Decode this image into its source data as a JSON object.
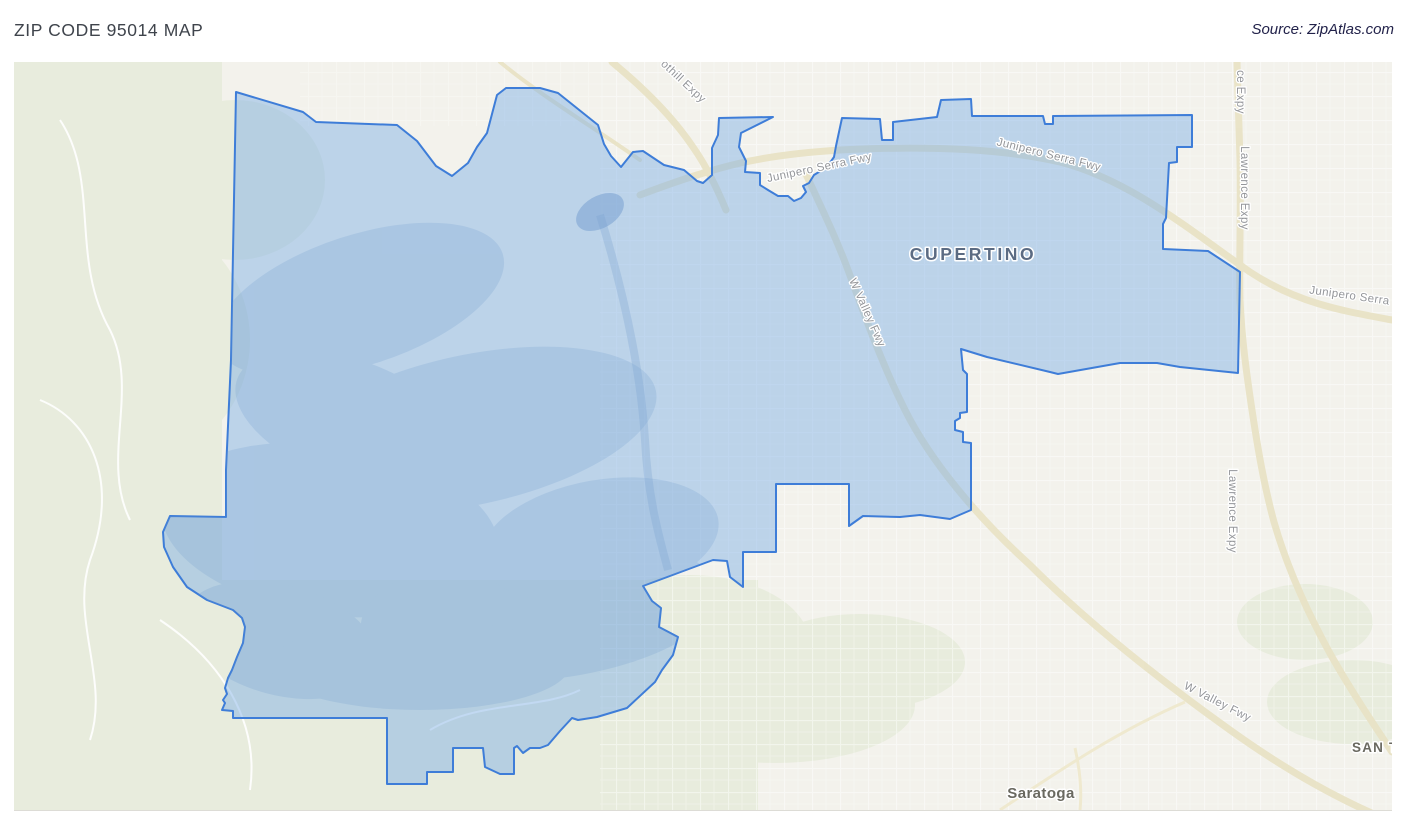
{
  "header": {
    "title": "ZIP CODE 95014 MAP",
    "source": "Source: ZipAtlas.com"
  },
  "map": {
    "colors": {
      "map_bg": "#f3f2ec",
      "greenery": "#e8ecdd",
      "freeway": "#e9e3c6",
      "minor_road": "#efe9cf",
      "boundary_stroke": "#3e7dd8",
      "boundary_fill": "rgba(122,172,230,0.45)",
      "hill_shade": "#6f9cce",
      "road_label": "#94969a",
      "city_label": "#5b6b83",
      "town_label": "#6a6960"
    },
    "city_labels": [
      {
        "name": "city-label-cupertino",
        "text": "CUPERTINO",
        "x": 973,
        "y": 260,
        "rotate": 0,
        "cls": "lbl-city",
        "anchor": "middle"
      },
      {
        "name": "town-label-saratoga",
        "text": "Saratoga",
        "x": 1041,
        "y": 798,
        "rotate": 0,
        "cls": "lbl-town",
        "anchor": "middle"
      },
      {
        "name": "town-label-san-tomas",
        "text": "SAN TO",
        "x": 1352,
        "y": 752,
        "rotate": 0,
        "cls": "lbl-town-caps",
        "anchor": "start"
      }
    ],
    "road_labels": [
      {
        "name": "road-label-junipero-serra-fwy-west",
        "text": "Junipero Serra Fwy",
        "x": 820,
        "y": 171,
        "rotate": -12,
        "cls": "lbl-road",
        "anchor": "middle"
      },
      {
        "name": "road-label-junipero-serra-fwy-east",
        "text": "Junipero Serra Fwy",
        "x": 1048,
        "y": 158,
        "rotate": 14,
        "cls": "lbl-road",
        "anchor": "middle"
      },
      {
        "name": "road-label-junipero-serra-right-edge",
        "text": "Junipero Serra",
        "x": 1349,
        "y": 299,
        "rotate": 8,
        "cls": "lbl-road",
        "anchor": "middle"
      },
      {
        "name": "road-label-lawrence-expy-top-cut",
        "text": "ce Expy",
        "x": 1237,
        "y": 92,
        "rotate": 90,
        "cls": "lbl-road",
        "anchor": "middle"
      },
      {
        "name": "road-label-lawrence-expy-upper",
        "text": "Lawrence Expy",
        "x": 1241,
        "y": 188,
        "rotate": 90,
        "cls": "lbl-road",
        "anchor": "middle"
      },
      {
        "name": "road-label-lawrence-expy-lower",
        "text": "Lawrence Expy",
        "x": 1229,
        "y": 511,
        "rotate": 90,
        "cls": "lbl-road",
        "anchor": "middle"
      },
      {
        "name": "road-label-w-valley-fwy-mid",
        "text": "W Valley Fwy",
        "x": 864,
        "y": 314,
        "rotate": 66,
        "cls": "lbl-road",
        "anchor": "middle"
      },
      {
        "name": "road-label-w-valley-fwy-bottom",
        "text": "W Valley Fwy",
        "x": 1216,
        "y": 705,
        "rotate": 27,
        "cls": "lbl-road",
        "anchor": "middle"
      },
      {
        "name": "road-label-foothill-expy-cut",
        "text": "othill Expy",
        "x": 681,
        "y": 84,
        "rotate": 43,
        "cls": "lbl-road",
        "anchor": "middle"
      }
    ],
    "zip_boundary": [
      [
        236,
        92
      ],
      [
        303,
        112
      ],
      [
        316,
        122
      ],
      [
        397,
        125
      ],
      [
        417,
        141
      ],
      [
        436,
        166
      ],
      [
        452,
        176
      ],
      [
        468,
        163
      ],
      [
        477,
        147
      ],
      [
        487,
        133
      ],
      [
        497,
        95
      ],
      [
        506,
        88
      ],
      [
        540,
        88
      ],
      [
        558,
        93
      ],
      [
        598,
        125
      ],
      [
        604,
        144
      ],
      [
        611,
        156
      ],
      [
        621,
        167
      ],
      [
        633,
        152
      ],
      [
        643,
        151
      ],
      [
        664,
        165
      ],
      [
        684,
        170
      ],
      [
        697,
        181
      ],
      [
        703,
        183
      ],
      [
        712,
        175
      ],
      [
        712,
        148
      ],
      [
        718,
        135
      ],
      [
        719,
        118
      ],
      [
        773,
        117
      ],
      [
        741,
        133
      ],
      [
        739,
        147
      ],
      [
        746,
        161
      ],
      [
        745,
        172
      ],
      [
        760,
        173
      ],
      [
        760,
        185
      ],
      [
        768,
        190
      ],
      [
        778,
        196
      ],
      [
        788,
        196
      ],
      [
        794,
        201
      ],
      [
        801,
        198
      ],
      [
        806,
        192
      ],
      [
        803,
        186
      ],
      [
        809,
        183
      ],
      [
        814,
        175
      ],
      [
        827,
        167
      ],
      [
        834,
        157
      ],
      [
        836,
        146
      ],
      [
        842,
        118
      ],
      [
        880,
        119
      ],
      [
        882,
        140
      ],
      [
        893,
        140
      ],
      [
        893,
        122
      ],
      [
        937,
        117
      ],
      [
        941,
        100
      ],
      [
        971,
        99
      ],
      [
        972,
        116
      ],
      [
        1043,
        116
      ],
      [
        1045,
        124
      ],
      [
        1053,
        124
      ],
      [
        1053,
        116
      ],
      [
        1192,
        115
      ],
      [
        1192,
        147
      ],
      [
        1177,
        147
      ],
      [
        1177,
        162
      ],
      [
        1169,
        163
      ],
      [
        1166,
        218
      ],
      [
        1163,
        224
      ],
      [
        1163,
        249
      ],
      [
        1208,
        251
      ],
      [
        1240,
        272
      ],
      [
        1238,
        373
      ],
      [
        1180,
        367
      ],
      [
        1157,
        363
      ],
      [
        1120,
        363
      ],
      [
        1058,
        374
      ],
      [
        1050,
        372
      ],
      [
        987,
        357
      ],
      [
        961,
        349
      ],
      [
        963,
        370
      ],
      [
        967,
        374
      ],
      [
        967,
        412
      ],
      [
        960,
        413
      ],
      [
        960,
        418
      ],
      [
        955,
        421
      ],
      [
        955,
        430
      ],
      [
        963,
        432
      ],
      [
        963,
        442
      ],
      [
        971,
        443
      ],
      [
        971,
        510
      ],
      [
        950,
        519
      ],
      [
        920,
        515
      ],
      [
        900,
        517
      ],
      [
        863,
        516
      ],
      [
        849,
        526
      ],
      [
        849,
        484
      ],
      [
        776,
        484
      ],
      [
        776,
        552
      ],
      [
        743,
        552
      ],
      [
        743,
        587
      ],
      [
        730,
        577
      ],
      [
        727,
        561
      ],
      [
        713,
        560
      ],
      [
        643,
        586
      ],
      [
        652,
        601
      ],
      [
        661,
        608
      ],
      [
        659,
        627
      ],
      [
        678,
        637
      ],
      [
        673,
        655
      ],
      [
        662,
        670
      ],
      [
        655,
        682
      ],
      [
        627,
        708
      ],
      [
        597,
        717
      ],
      [
        578,
        720
      ],
      [
        572,
        718
      ],
      [
        560,
        731
      ],
      [
        548,
        745
      ],
      [
        540,
        748
      ],
      [
        530,
        748
      ],
      [
        523,
        753
      ],
      [
        517,
        746
      ],
      [
        514,
        748
      ],
      [
        514,
        774
      ],
      [
        500,
        774
      ],
      [
        485,
        767
      ],
      [
        483,
        748
      ],
      [
        453,
        748
      ],
      [
        453,
        772
      ],
      [
        427,
        772
      ],
      [
        427,
        784
      ],
      [
        387,
        784
      ],
      [
        387,
        718
      ],
      [
        233,
        718
      ],
      [
        233,
        711
      ],
      [
        222,
        710
      ],
      [
        225,
        703
      ],
      [
        223,
        700
      ],
      [
        227,
        694
      ],
      [
        225,
        688
      ],
      [
        228,
        678
      ],
      [
        232,
        670
      ],
      [
        237,
        657
      ],
      [
        243,
        643
      ],
      [
        245,
        627
      ],
      [
        242,
        618
      ],
      [
        233,
        610
      ],
      [
        220,
        605
      ],
      [
        207,
        600
      ],
      [
        187,
        587
      ],
      [
        173,
        567
      ],
      [
        164,
        547
      ],
      [
        163,
        532
      ],
      [
        170,
        516
      ],
      [
        226,
        517
      ],
      [
        226,
        470
      ],
      [
        231,
        360
      ]
    ]
  }
}
